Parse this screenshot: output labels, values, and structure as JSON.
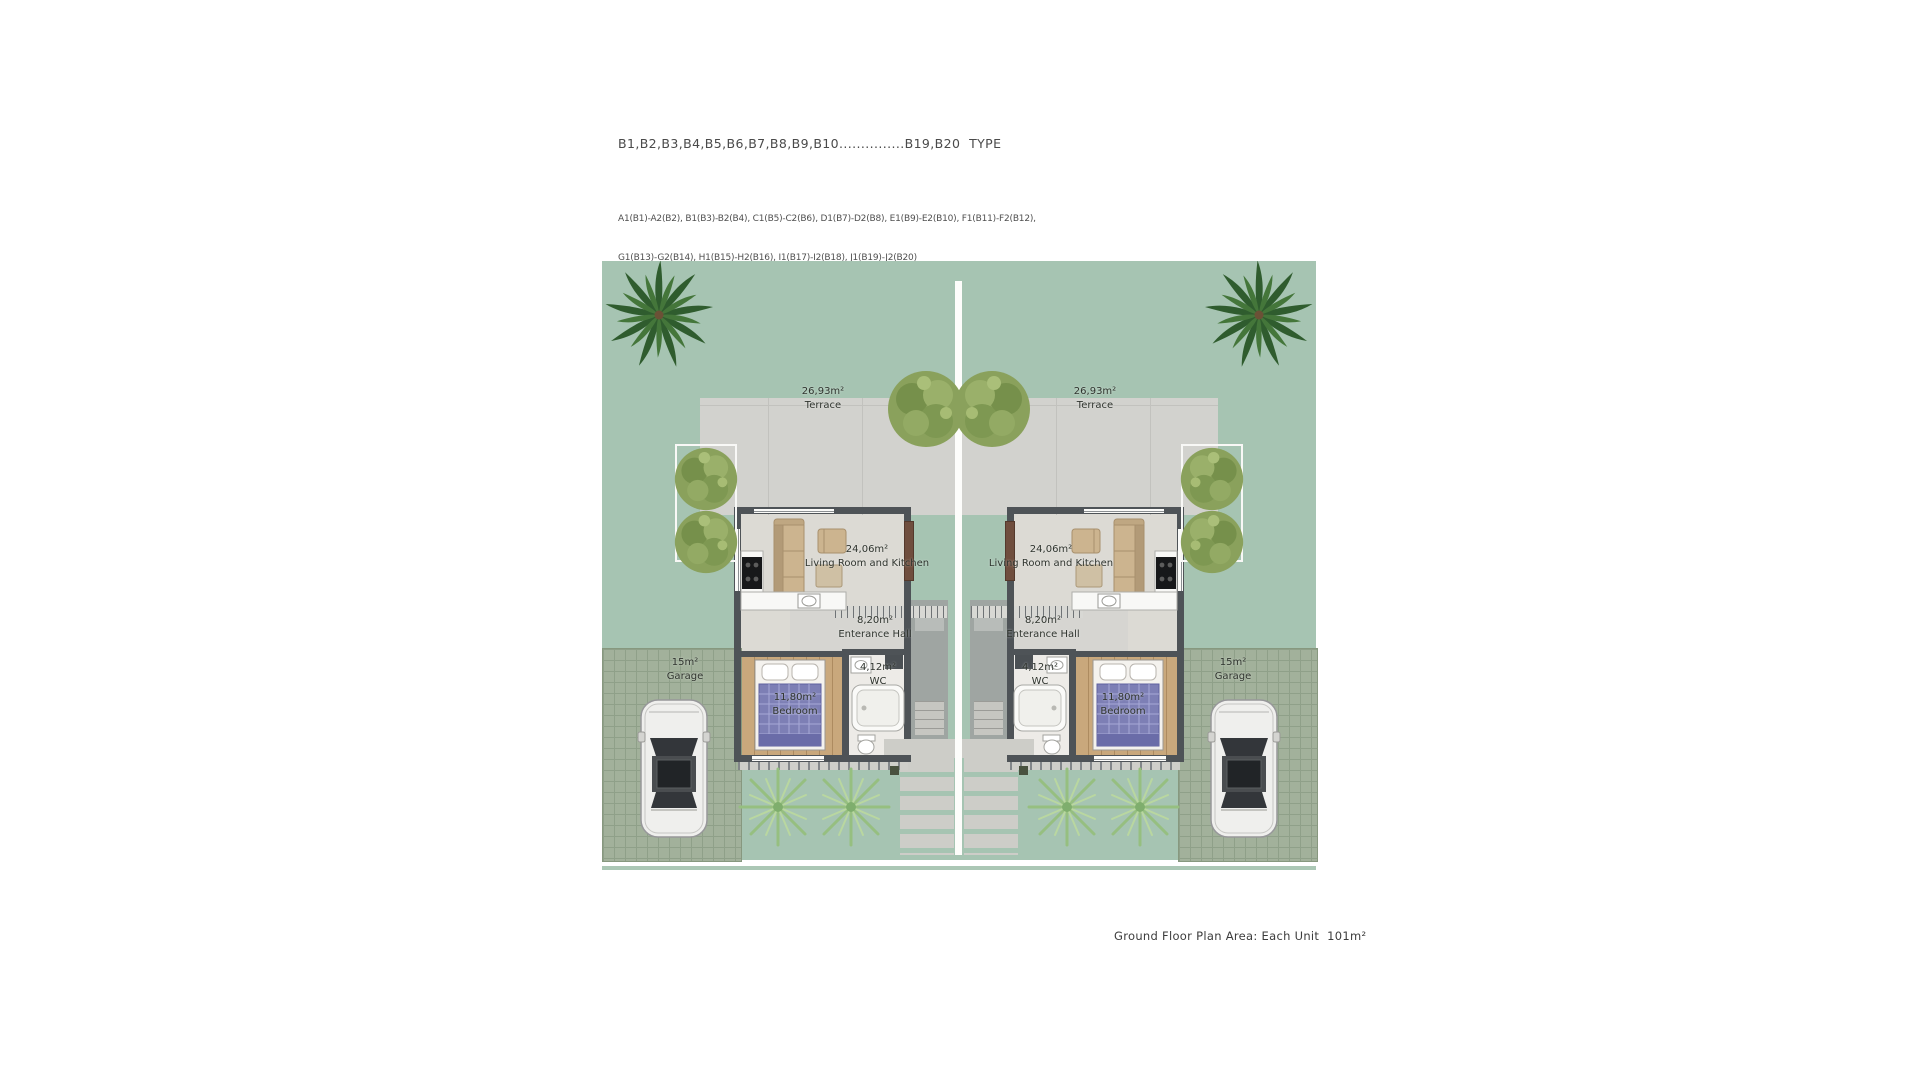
{
  "header": {
    "type_line": "B1,B2,B3,B4,B5,B6,B7,B8,B9,B10...............B19,B20  TYPE",
    "pair_line_1": "A1(B1)-A2(B2), B1(B3)-B2(B4), C1(B5)-C2(B6), D1(B7)-D2(B8), E1(B9)-E2(B10), F1(B11)-F2(B12),",
    "pair_line_2": "G1(B13)-G2(B14), H1(B15)-H2(B16), I1(B17)-I2(B18), J1(B19)-J2(B20)"
  },
  "rooms": {
    "terrace": {
      "area": "26,93m²",
      "name": "Terrace"
    },
    "living": {
      "area": "24,06m²",
      "name": "Living Room and Kitchen"
    },
    "hall": {
      "area": "8,20m²",
      "name": "Enterance Hall"
    },
    "wc": {
      "area": "4,12m²",
      "name": "WC"
    },
    "bedroom": {
      "area": "11,80m²",
      "name": "Bedroom"
    },
    "garage": {
      "area": "15m²",
      "name": "Garage"
    }
  },
  "footer": {
    "caption": "Ground Floor Plan Area: Each Unit  101m²"
  },
  "colors": {
    "site_green": "#a6c4b2",
    "paving": "#d2d2ce",
    "wall": "#4e5357",
    "wood": "#c9a87c",
    "tree_green": "#8aa15c",
    "palm_green": "#2f5c2e"
  }
}
